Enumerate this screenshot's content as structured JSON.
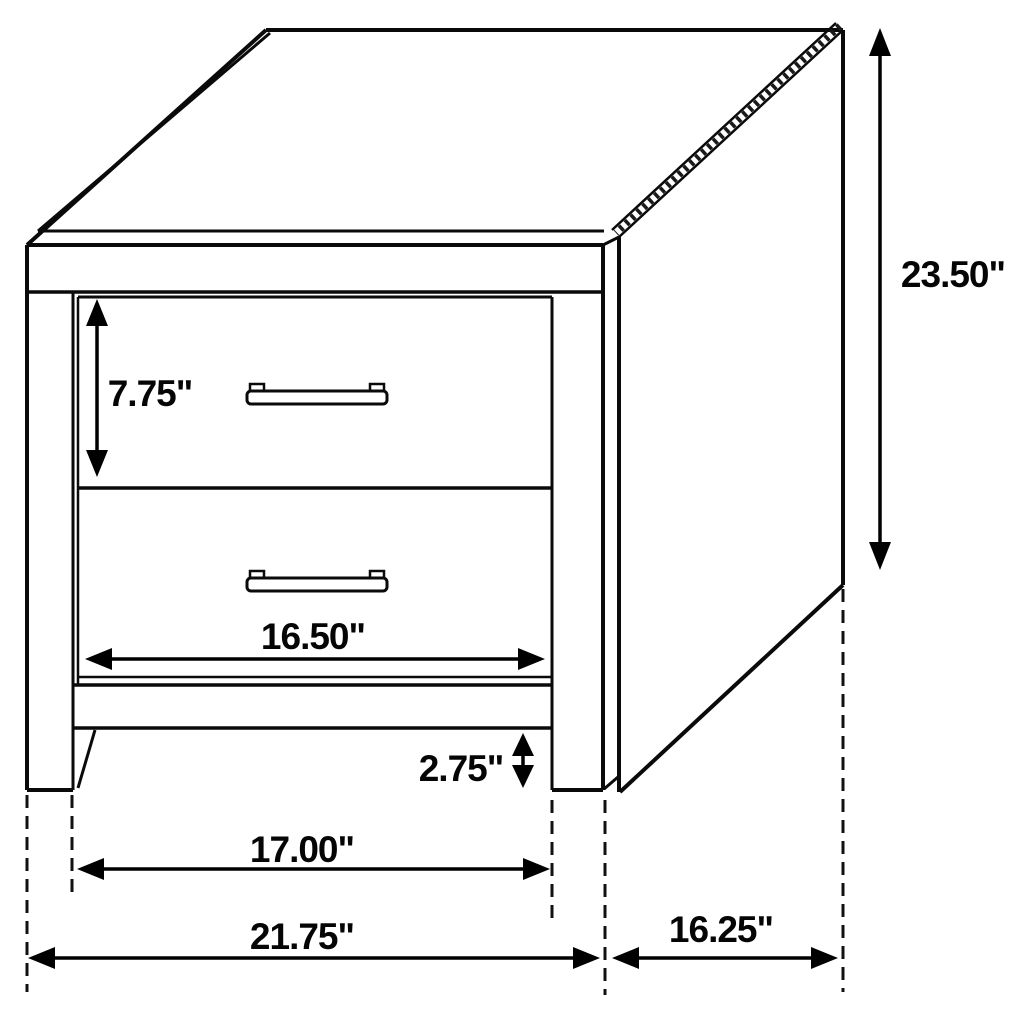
{
  "diagram": {
    "subject": "two-drawer nightstand dimension drawing",
    "unit": "inches",
    "colors": {
      "line": "#0a0a0a",
      "background": "#ffffff",
      "dimension_text": "#050505"
    },
    "dimensions": {
      "drawer_height": "7.75\"",
      "overall_height": "23.50\"",
      "drawer_width": "16.50\"",
      "leg_clearance": "2.75\"",
      "inner_width": "17.00\"",
      "overall_width": "21.75\"",
      "depth": "16.25\""
    }
  }
}
